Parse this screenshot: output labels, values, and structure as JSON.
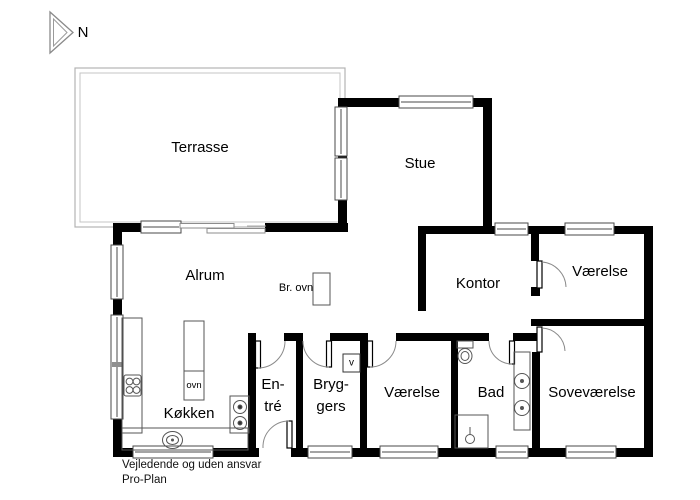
{
  "north": {
    "label": "N"
  },
  "rooms": {
    "terrasse": "Terrasse",
    "stue": "Stue",
    "alrum": "Alrum",
    "kontor": "Kontor",
    "vaerelse_ne": "Værelse",
    "vaerelse_s": "Værelse",
    "bad": "Bad",
    "sovevaerelse": "Soveværelse",
    "koekken": "Køkken",
    "entre": {
      "line1": "En-",
      "line2": "tré"
    },
    "bryggers": {
      "line1": "Bryg-",
      "line2": "gers"
    }
  },
  "annotations": {
    "br_ovn": "Br. ovn",
    "ovn": "ovn",
    "vent": "v"
  },
  "footer": {
    "line1": "Vejledende og uden ansvar",
    "line2": "Pro-Plan"
  },
  "colors": {
    "wall": "#000000",
    "fixture_line": "#555555",
    "door_arc": "#888888",
    "terrace_outline": "#b3b3b3",
    "background": "#ffffff"
  }
}
